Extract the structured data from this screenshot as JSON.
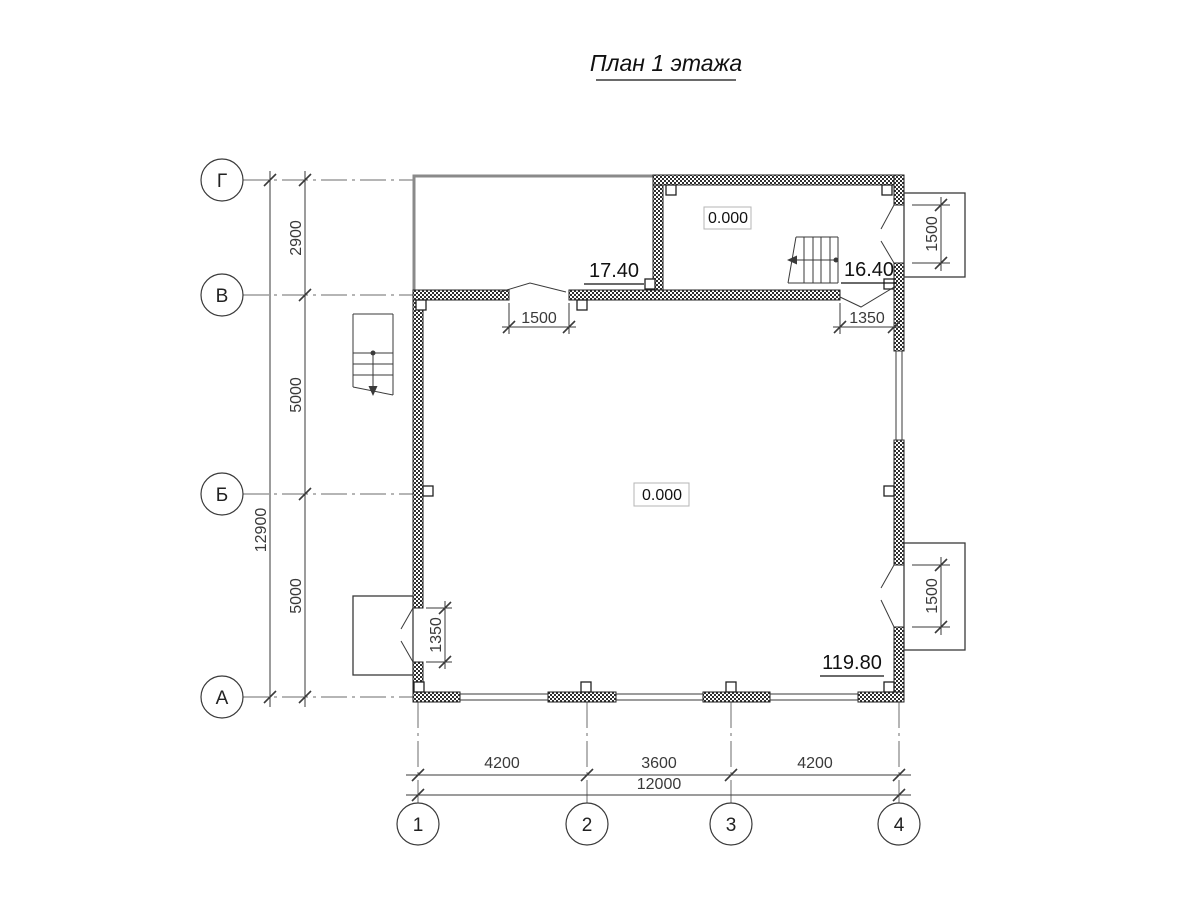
{
  "title": {
    "text": "План 1 этажа"
  },
  "axes": {
    "rows": [
      {
        "label": "Г"
      },
      {
        "label": "В"
      },
      {
        "label": "Б"
      },
      {
        "label": "А"
      }
    ],
    "cols": [
      {
        "label": "1"
      },
      {
        "label": "2"
      },
      {
        "label": "3"
      },
      {
        "label": "4"
      }
    ]
  },
  "dims": {
    "row_total": "12900",
    "row_segments": [
      {
        "value": "2900"
      },
      {
        "value": "5000"
      },
      {
        "value": "5000"
      }
    ],
    "col_total": "12000",
    "col_segments": [
      {
        "value": "4200"
      },
      {
        "value": "3600"
      },
      {
        "value": "4200"
      }
    ],
    "door_top_center": "1500",
    "door_top_right": "1350",
    "door_left": "1350",
    "porch_top_right_opening": "1500",
    "porch_bottom_right_opening": "1500"
  },
  "rooms": {
    "terrace_area": "17.40",
    "hall_area": "16.40",
    "main_area": "119.80",
    "hall_elevation": "0.000",
    "main_elevation": "0.000"
  },
  "colors": {
    "line": "#3a3a3a",
    "wall": "#222222",
    "terrace_outline": "#8a8a8a",
    "elevation_box_border": "#b5b5b5",
    "background": "#ffffff"
  }
}
